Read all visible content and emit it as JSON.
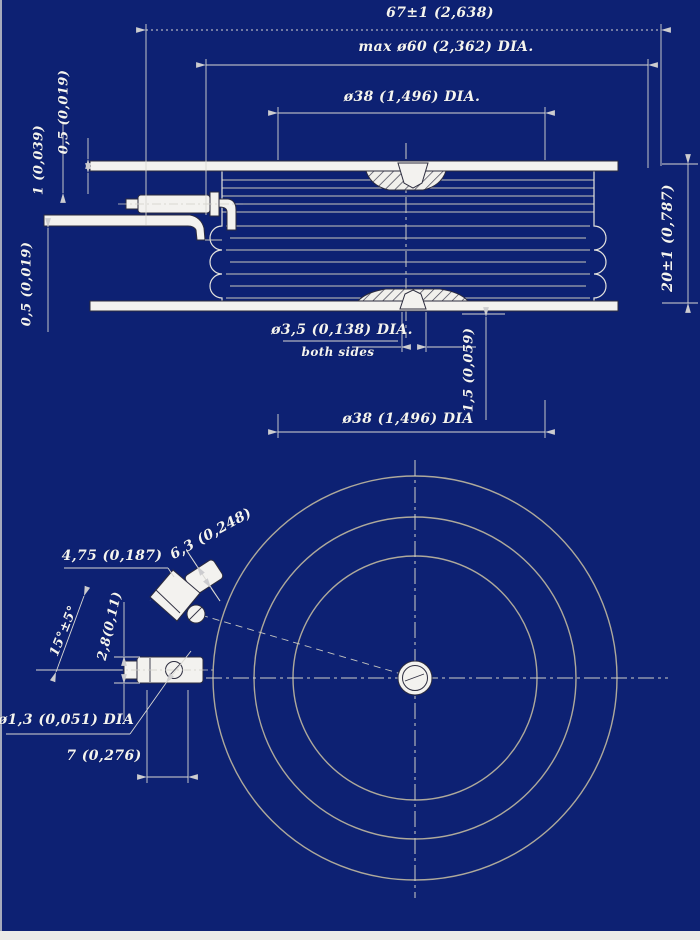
{
  "drawing": {
    "type": "technical-drawing",
    "subject": "disc (puck) semiconductor device, side section and bottom view",
    "background_color": "#0d2173",
    "line_color": "#e4e3de",
    "text_color": "#f4f4f0",
    "frame_strip_color": "#ebebe8"
  },
  "side_view": {
    "dim_overall": "67±1 (2,638)",
    "dim_max_dia": "max ø60 (2,362) DIA.",
    "dim_top_contact": "ø38 (1,496) DIA.",
    "dim_top_lead": "0,5 (0,019)",
    "dim_gate_lead": "1 (0,039)",
    "dim_lower_lead": "0,5 (0,019)",
    "dim_height": "20±1 (0,787)",
    "dim_hole": "ø3,5 (0,138) DIA.",
    "dim_hole_note": "both sides",
    "dim_recess": "1,5 (0,059)",
    "dim_bottom_contact": "ø38 (1,496) DIA"
  },
  "bottom_view": {
    "dim_terminal_len": "4,75 (0,187)",
    "dim_tab": "6,3 (0,248)",
    "dim_angle": "15°±5°",
    "dim_conn_height": "2,8(0,11)",
    "dim_pin_dia": "ø1,3 (0,051) DIA",
    "dim_offset": "7 (0,276)"
  }
}
